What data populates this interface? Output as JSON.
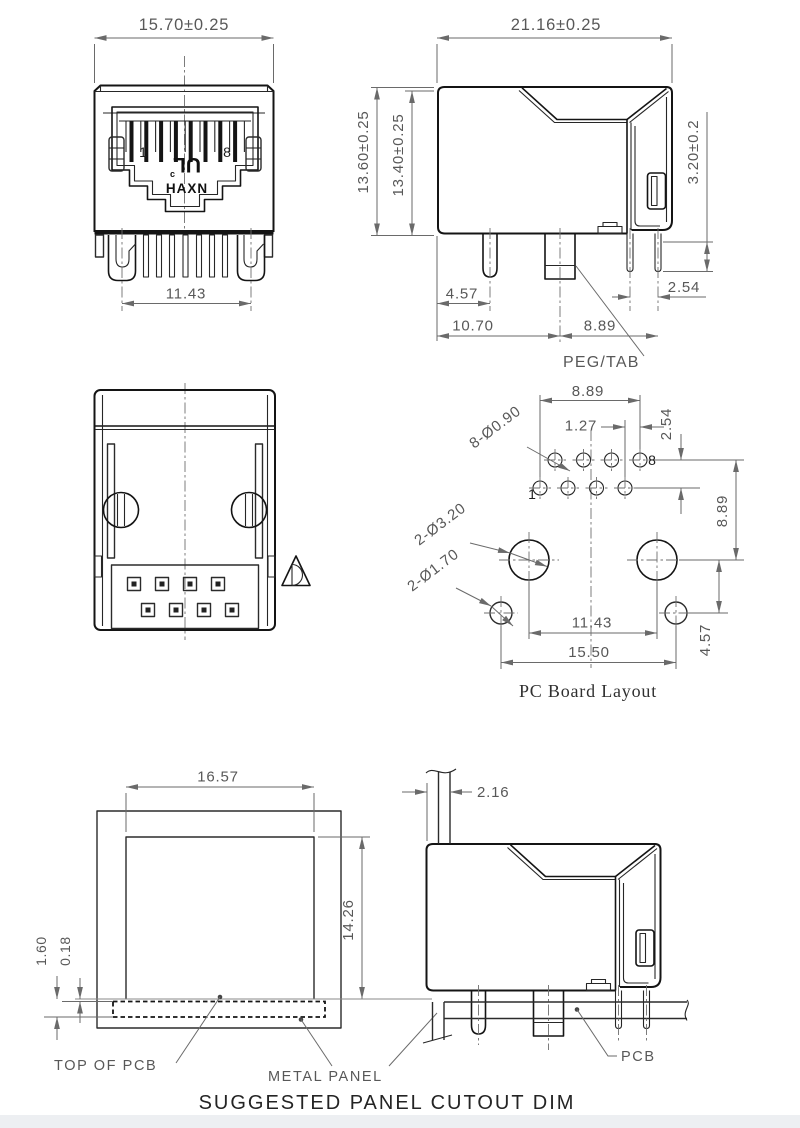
{
  "front_view": {
    "width_dim": "15.70±0.25",
    "shield_span_dim": "11.43",
    "pin_first": "1",
    "pin_last": "8",
    "ul_c": "c",
    "ul_mark": "UL",
    "brand": "HAXN"
  },
  "side_view": {
    "depth_dim": "21.16±0.25",
    "height_outer_dim": "13.60±0.25",
    "height_inner_dim": "13.40±0.25",
    "panel_stop_dim": "3.20±0.2",
    "peg_offset_dim": "4.57",
    "pegtab_offset_dim": "10.70",
    "pin_span_dim": "8.89",
    "pin_pitch_dim": "2.54",
    "pegtab_label": "PEG/TAB"
  },
  "bottom_view": {
    "projection_symbol_icon": "third-angle-projection"
  },
  "pcb_layout": {
    "title": "PC Board Layout",
    "pin_span_dim": "8.89",
    "pin_pitch_dim": "1.27",
    "row_pitch_dim": "2.54",
    "row_to_peg_dim": "8.89",
    "peg_to_hole_dim": "4.57",
    "peg_spacing_dim": "11.43",
    "hole_spacing_dim": "15.50",
    "pin_holes_label": "8-Ø0.90",
    "peg_holes_label": "2-Ø3.20",
    "mount_holes_label": "2-Ø1.70",
    "pin_first": "1",
    "pin_last": "8"
  },
  "panel_cutout": {
    "width_dim": "16.57",
    "height_dim": "14.26",
    "pcb_edge_dim": "1.60",
    "gap_dim": "0.18",
    "top_of_pcb_label": "TOP OF PCB",
    "metal_panel_label": "METAL PANEL"
  },
  "panel_side_view": {
    "panel_thickness_dim": "2.16",
    "pcb_label": "PCB"
  },
  "footer_title": "SUGGESTED PANEL CUTOUT DIM"
}
